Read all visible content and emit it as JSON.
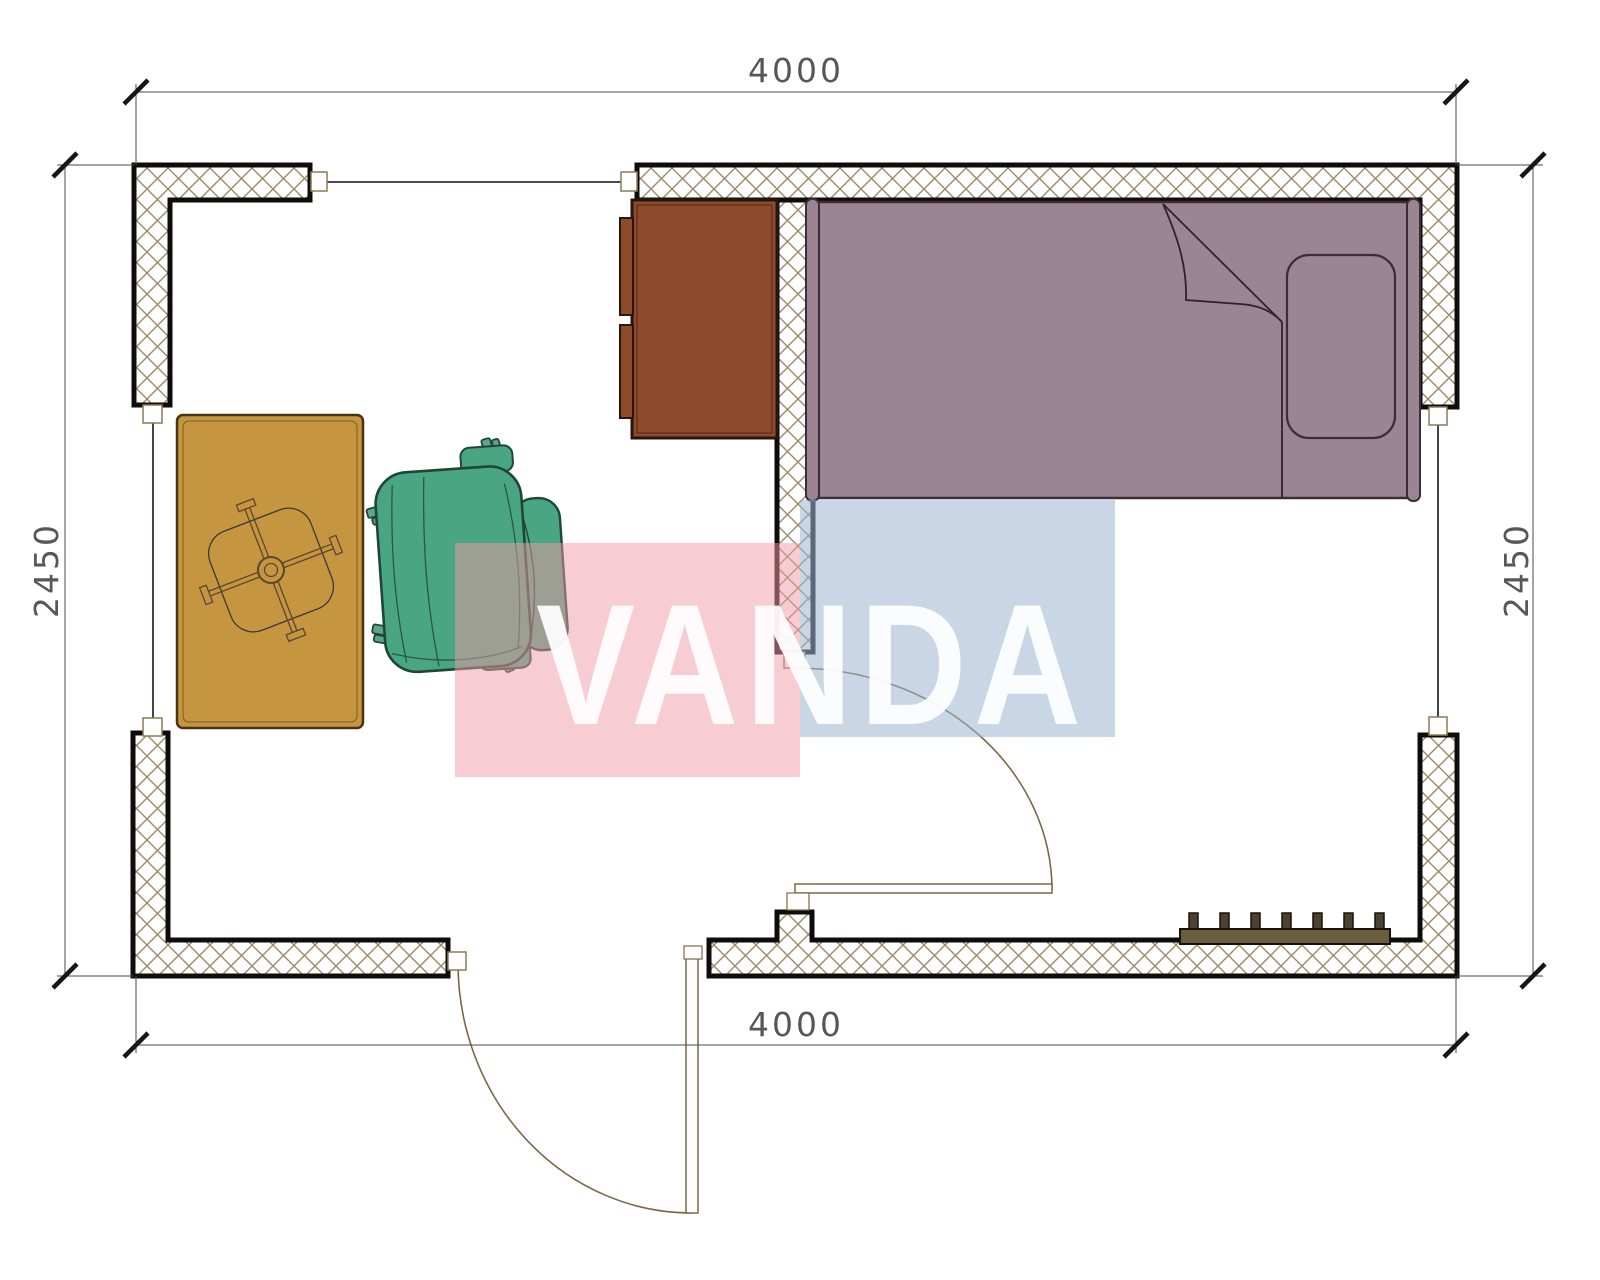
{
  "dimensions": {
    "top": "4000",
    "bottom": "4000",
    "left": "2450",
    "right": "2450"
  },
  "watermark": {
    "text": "VANDA",
    "text_color": "#ffffff",
    "red_block_color": "#ef9aa6",
    "blue_block_color": "#9cb4cf"
  },
  "colors": {
    "background": "#ffffff",
    "wall_outline": "#0e0d0b",
    "wall_hatch": "#9b8a6a",
    "dimension_line": "#4a4a4a",
    "dimension_text": "#575757",
    "window_line": "#2e2e45",
    "connector_outline": "#8a7a58",
    "door": "#7a6845",
    "bed_fill": "#9c8593",
    "bed_outline": "#3a2c38",
    "cabinet_fill": "#8d4b2b",
    "cabinet_outline": "#27160e",
    "table_fill": "#c6953f",
    "table_outline": "#4a3215",
    "fan_line": "#5a4632",
    "chair_fill": "#4aa583",
    "chair_outline": "#1f4636",
    "radiator_bar": "#6b5e3e",
    "radiator_teeth": "#4a4233"
  }
}
